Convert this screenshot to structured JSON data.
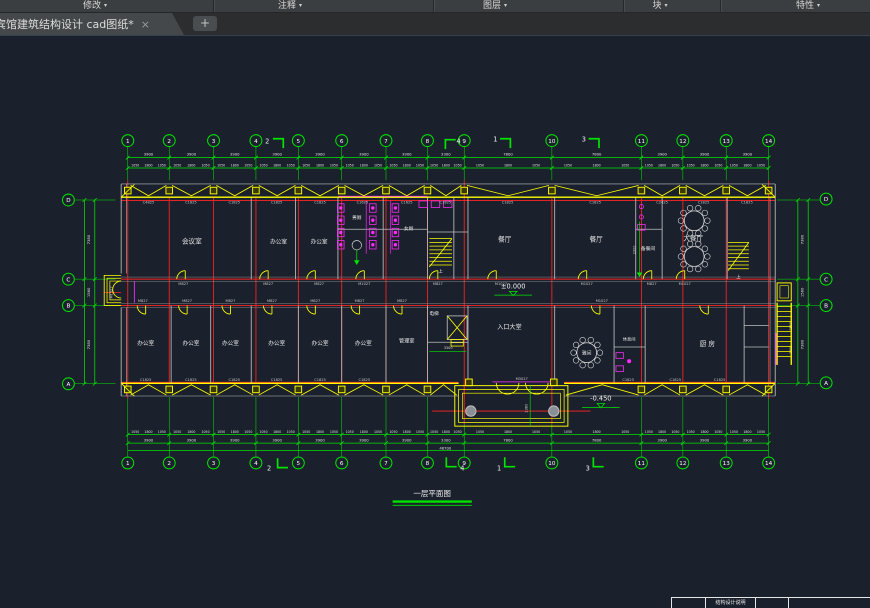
{
  "ribbon": {
    "panels": [
      {
        "label": "修改"
      },
      {
        "label": "注释"
      },
      {
        "label": "图层"
      },
      {
        "label": "块"
      },
      {
        "label": "特性"
      }
    ],
    "dropdown_glyph": "▾"
  },
  "tabs": {
    "active_title": "宾馆建筑结构设计 cad图纸*",
    "close_glyph": "×",
    "new_tab_glyph": "+"
  },
  "sheet_table": {
    "label": "结构设计说明"
  },
  "plan": {
    "colors": {
      "background": "#1b212c",
      "grid_green": "#00e400",
      "wall_red": "#ff2222",
      "detail_yellow": "#ffff00",
      "fixture_magenta": "#ff2bff",
      "wall_gray": "#bdbdbd",
      "text": "#e2e2e2"
    },
    "title": {
      "text": "一层平面图",
      "x": 432,
      "y": 523
    },
    "grid": {
      "top": {
        "y": 146,
        "labels": [
          "1",
          "2",
          "3",
          "4",
          "5",
          "6",
          "7",
          "8",
          "9",
          "10",
          "11",
          "12",
          "13",
          "14"
        ],
        "xs": [
          109,
          153,
          200,
          245,
          290,
          336,
          383,
          427,
          466,
          559,
          654,
          698,
          744,
          789
        ]
      },
      "bottom": {
        "y": 488,
        "labels": [
          "1",
          "2",
          "3",
          "4",
          "5",
          "6",
          "7",
          "8",
          "9",
          "10",
          "11",
          "12",
          "13",
          "14"
        ],
        "xs": [
          109,
          153,
          200,
          245,
          290,
          336,
          383,
          427,
          466,
          559,
          654,
          698,
          744,
          789
        ]
      },
      "left": {
        "x": 46,
        "labels": [
          "D",
          "C",
          "B",
          "A"
        ],
        "ys": [
          209,
          293,
          321,
          404
        ]
      },
      "right": {
        "x": 850,
        "labels": [
          "D",
          "C",
          "B",
          "A"
        ],
        "ys": [
          208,
          293,
          321,
          403
        ]
      }
    },
    "dims": {
      "axis_values": [
        "3900",
        "3900",
        "3900",
        "3900",
        "3900",
        "3900",
        "3900",
        "3300",
        "7800",
        "7800",
        "3900",
        "3900",
        "3900"
      ],
      "detail_pattern": [
        "1050",
        "1800",
        "1050"
      ],
      "total_bottom": "48700",
      "left_values": [
        "7380",
        "1560",
        "7380"
      ],
      "right_values": [
        "7380",
        "1560",
        "7380"
      ],
      "right_inner_values": [
        "2580",
        "2580"
      ]
    },
    "rooms": [
      {
        "t": "会议室",
        "x": 177,
        "y": 255,
        "s": 7
      },
      {
        "t": "办公室",
        "x": 269,
        "y": 255,
        "s": 6
      },
      {
        "t": "办公室",
        "x": 312,
        "y": 255,
        "s": 6
      },
      {
        "t": "男厕",
        "x": 352,
        "y": 229,
        "s": 5
      },
      {
        "t": "女厕",
        "x": 407,
        "y": 241,
        "s": 5
      },
      {
        "t": "餐厅",
        "x": 509,
        "y": 253,
        "s": 7
      },
      {
        "t": "餐厅",
        "x": 606,
        "y": 253,
        "s": 7
      },
      {
        "t": "备餐间",
        "x": 661,
        "y": 262,
        "s": 5
      },
      {
        "t": "大餐厅",
        "x": 709,
        "y": 252,
        "s": 7
      },
      {
        "t": "办公室",
        "x": 128,
        "y": 363,
        "s": 6
      },
      {
        "t": "办公室",
        "x": 176,
        "y": 363,
        "s": 6
      },
      {
        "t": "办公室",
        "x": 218,
        "y": 363,
        "s": 6
      },
      {
        "t": "办公室",
        "x": 267,
        "y": 363,
        "s": 6
      },
      {
        "t": "办公室",
        "x": 313,
        "y": 363,
        "s": 6
      },
      {
        "t": "办公室",
        "x": 359,
        "y": 363,
        "s": 6
      },
      {
        "t": "管理室",
        "x": 405,
        "y": 360,
        "s": 5.5
      },
      {
        "t": "电梯",
        "x": 434,
        "y": 331,
        "s": 5
      },
      {
        "t": "入口大堂",
        "x": 514,
        "y": 346,
        "s": 6.5
      },
      {
        "t": "雅间",
        "x": 596,
        "y": 373,
        "s": 5
      },
      {
        "t": "休息间",
        "x": 641,
        "y": 358,
        "s": 4.5
      },
      {
        "t": "厨 房",
        "x": 724,
        "y": 364,
        "s": 7
      },
      {
        "t": "上",
        "x": 441,
        "y": 286,
        "s": 4.5
      },
      {
        "t": "上",
        "x": 757,
        "y": 292,
        "s": 4.5
      }
    ],
    "codes": [
      {
        "t": "C4825",
        "x": 131,
        "y": 213
      },
      {
        "t": "C1825",
        "x": 176,
        "y": 213
      },
      {
        "t": "C1825",
        "x": 222,
        "y": 213
      },
      {
        "t": "C1825",
        "x": 267,
        "y": 213
      },
      {
        "t": "C1825",
        "x": 313,
        "y": 213
      },
      {
        "t": "C1625",
        "x": 358,
        "y": 213
      },
      {
        "t": "C1625",
        "x": 405,
        "y": 213
      },
      {
        "t": "C1825",
        "x": 446,
        "y": 213
      },
      {
        "t": "C1825",
        "x": 512,
        "y": 213
      },
      {
        "t": "C1825",
        "x": 605,
        "y": 213
      },
      {
        "t": "C2425",
        "x": 676,
        "y": 213
      },
      {
        "t": "C1825",
        "x": 720,
        "y": 213
      },
      {
        "t": "C1825",
        "x": 766,
        "y": 213
      },
      {
        "t": "M827",
        "x": 168,
        "y": 299
      },
      {
        "t": "M827",
        "x": 258,
        "y": 299
      },
      {
        "t": "M827",
        "x": 312,
        "y": 299
      },
      {
        "t": "M1027",
        "x": 360,
        "y": 299
      },
      {
        "t": "M827",
        "x": 438,
        "y": 299
      },
      {
        "t": "M1027",
        "x": 505,
        "y": 299
      },
      {
        "t": "M1027",
        "x": 596,
        "y": 299
      },
      {
        "t": "M827",
        "x": 665,
        "y": 299
      },
      {
        "t": "M1027",
        "x": 700,
        "y": 299
      },
      {
        "t": "M827",
        "x": 125,
        "y": 317
      },
      {
        "t": "M827",
        "x": 172,
        "y": 317
      },
      {
        "t": "M827",
        "x": 218,
        "y": 317
      },
      {
        "t": "M827",
        "x": 262,
        "y": 317
      },
      {
        "t": "M827",
        "x": 308,
        "y": 317
      },
      {
        "t": "M827",
        "x": 355,
        "y": 317
      },
      {
        "t": "M827",
        "x": 400,
        "y": 317
      },
      {
        "t": "M1027",
        "x": 612,
        "y": 317
      },
      {
        "t": "C1825",
        "x": 128,
        "y": 401
      },
      {
        "t": "C1825",
        "x": 176,
        "y": 401
      },
      {
        "t": "C1825",
        "x": 222,
        "y": 401
      },
      {
        "t": "C1825",
        "x": 267,
        "y": 401
      },
      {
        "t": "C1825",
        "x": 313,
        "y": 401
      },
      {
        "t": "C1825",
        "x": 360,
        "y": 401
      },
      {
        "t": "M3027",
        "x": 527,
        "y": 400
      },
      {
        "t": "C1825",
        "x": 640,
        "y": 401
      },
      {
        "t": "C1825",
        "x": 690,
        "y": 401
      },
      {
        "t": "C1825",
        "x": 737,
        "y": 401
      },
      {
        "t": "M1527",
        "x": 93,
        "y": 307,
        "rot": 1
      }
    ],
    "elevations": [
      {
        "t": "±0.000",
        "x": 518,
        "y": 303
      },
      {
        "t": "-0.450",
        "x": 611,
        "y": 422
      }
    ],
    "interior_dims": [
      {
        "t": "2300",
        "x": 648,
        "y": 262,
        "rot": 1
      },
      {
        "t": "3300",
        "x": 449,
        "y": 367,
        "rot": 0
      },
      {
        "t": "2380",
        "x": 533,
        "y": 430,
        "rot": 1
      }
    ],
    "sections": [
      {
        "n": "2",
        "x": 257,
        "y": 149,
        "flag": [
          263,
          144,
          274,
          144,
          274,
          154
        ]
      },
      {
        "n": "4",
        "x": 460,
        "y": 149,
        "flag": [
          446,
          155,
          446,
          145,
          457,
          145
        ]
      },
      {
        "n": "1",
        "x": 499,
        "y": 147,
        "flag": [
          504,
          144,
          515,
          144,
          515,
          154
        ]
      },
      {
        "n": "3",
        "x": 593,
        "y": 147,
        "flag": [
          598,
          144,
          609,
          144,
          609,
          154
        ]
      },
      {
        "n": "2",
        "x": 259,
        "y": 496,
        "flag": [
          268,
          483,
          268,
          493,
          279,
          493
        ]
      },
      {
        "n": "4",
        "x": 464,
        "y": 496,
        "flag": [
          447,
          482,
          447,
          492,
          458,
          492
        ]
      },
      {
        "n": "1",
        "x": 503,
        "y": 496,
        "flag": [
          509,
          482,
          509,
          492,
          520,
          492
        ]
      },
      {
        "n": "3",
        "x": 597,
        "y": 496,
        "flag": [
          603,
          482,
          603,
          492,
          614,
          492
        ]
      }
    ]
  }
}
